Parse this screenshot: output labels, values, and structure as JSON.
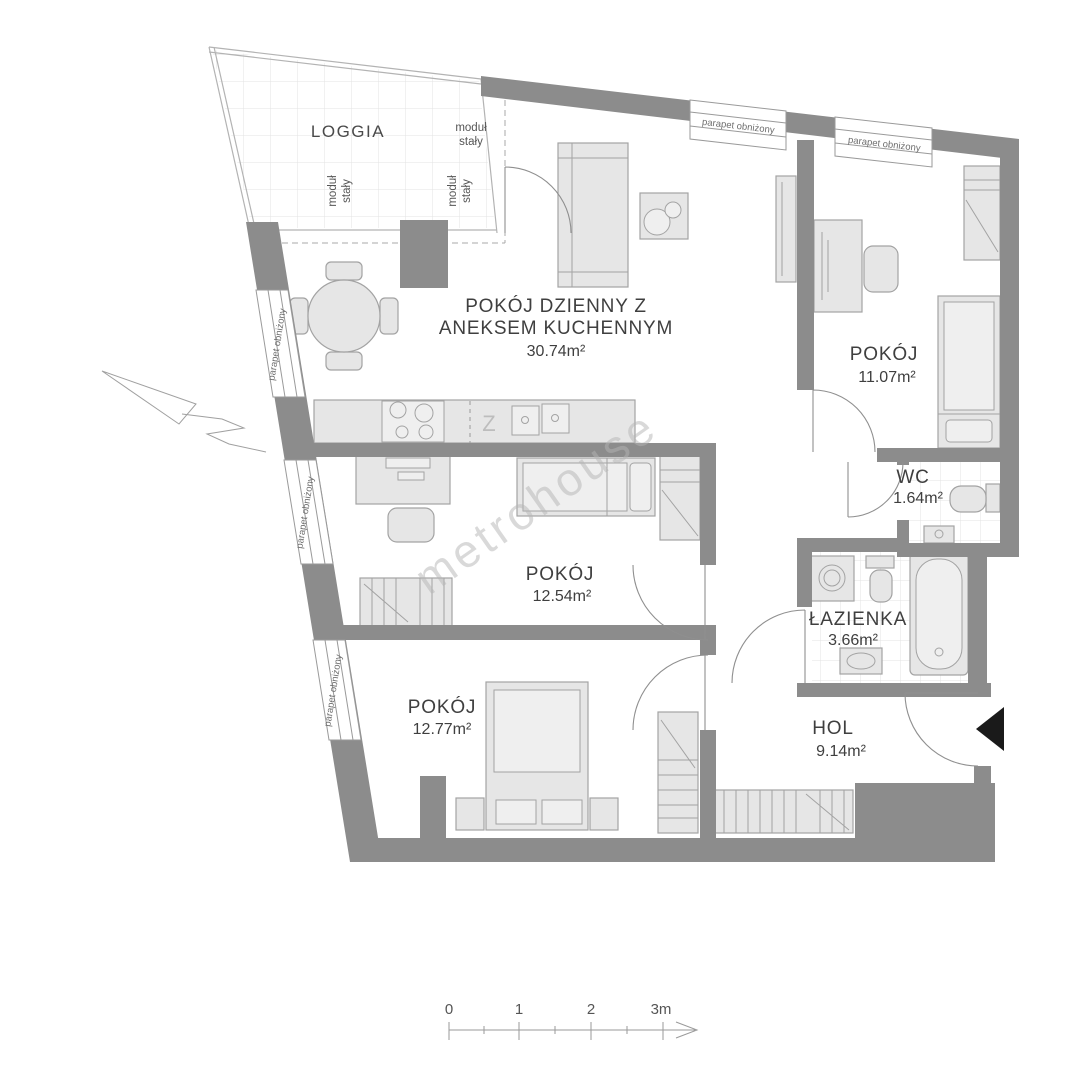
{
  "plan": {
    "watermark": "metrohouse",
    "rooms": {
      "living": {
        "name_line1": "POKÓJ DZIENNY Z",
        "name_line2": "ANEKSEM KUCHENNYM",
        "area": "30.74m²"
      },
      "bedroom_top": {
        "name": "POKÓJ",
        "area": "11.07m²"
      },
      "wc": {
        "name": "WC",
        "area": "1.64m²"
      },
      "bathroom": {
        "name": "ŁAZIENKA",
        "area": "3.66m²"
      },
      "bedroom_middle": {
        "name": "POKÓJ",
        "area": "12.54m²"
      },
      "bedroom_bottom": {
        "name": "POKÓJ",
        "area": "12.77m²"
      },
      "hall": {
        "name": "HOL",
        "area": "9.14m²"
      }
    },
    "loggia": {
      "name": "LOGGIA",
      "module_line1": "moduł",
      "module_line2": "stały"
    },
    "window_label": "parapet obniżony",
    "kitchen_sink_marker": "Z",
    "scale_bar": {
      "tick0": "0",
      "tick1": "1",
      "tick2": "2",
      "tick3": "3m"
    },
    "colors": {
      "wall": "#8c8c8c",
      "furniture_fill": "#e6e6e6",
      "furniture_stroke": "#a3a3a3"
    }
  }
}
